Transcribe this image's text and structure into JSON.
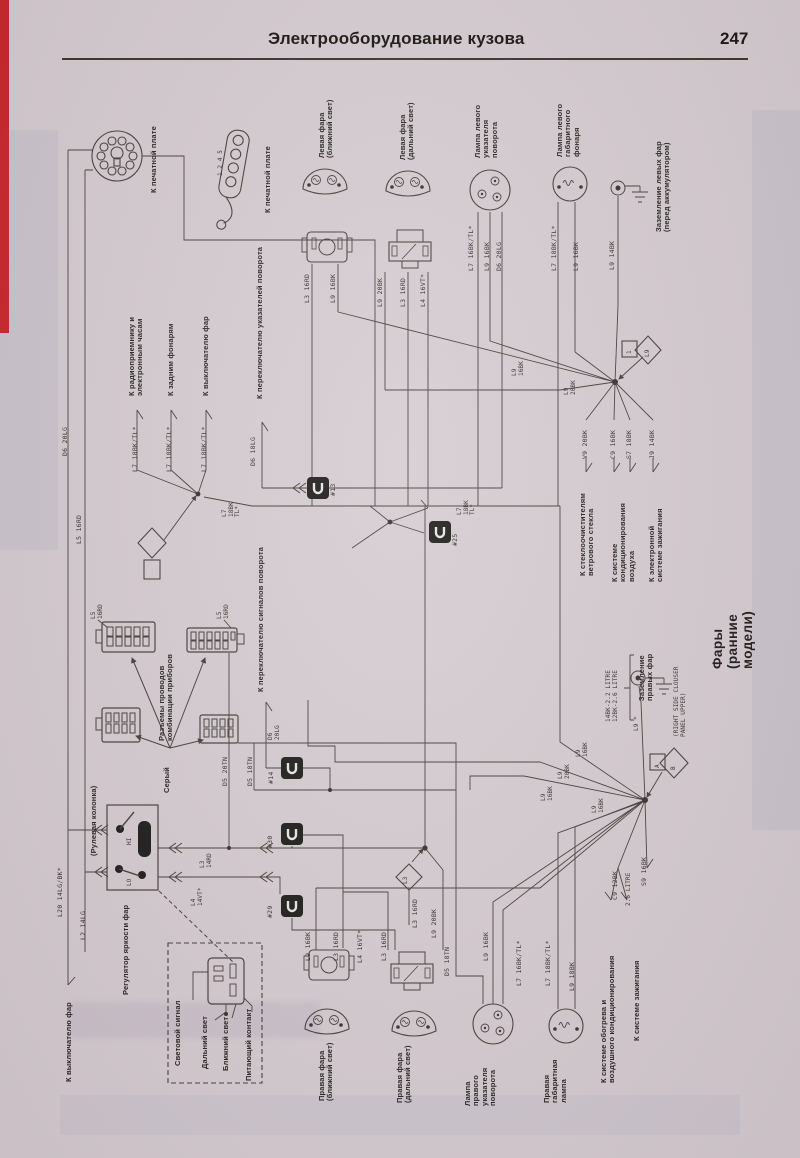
{
  "header": {
    "title": "Электрооборудование кузова",
    "page_number": "247"
  },
  "colors": {
    "paper": "#d5ccd1",
    "ink": "#45403a",
    "stripe_red": "#c9252b"
  },
  "diagram": {
    "title": "Фары (ранние модели)",
    "labels": [
      {
        "t": "К печатной плате",
        "x": 150,
        "y": 193,
        "c": "comp"
      },
      {
        "t": "К печатной плате",
        "x": 264,
        "y": 213,
        "c": "comp"
      },
      {
        "t": "1 2 4 5",
        "x": 218,
        "y": 176,
        "c": "tiny",
        "n": "pin-numbers-label"
      },
      {
        "t": "Левая фара\n(ближний свет)",
        "x": 318,
        "y": 158,
        "c": "comp"
      },
      {
        "t": "Левая фара\n(дальний свет)",
        "x": 399,
        "y": 160,
        "c": "comp"
      },
      {
        "t": "Лампа левого\nуказателя\nповорота",
        "x": 474,
        "y": 158,
        "c": "comp"
      },
      {
        "t": "Лампа левого\nгабаритного\nфонаря",
        "x": 556,
        "y": 157,
        "c": "comp"
      },
      {
        "t": "Заземление левых фар\n(перед аккумулятором)",
        "x": 655,
        "y": 232,
        "c": "comp"
      },
      {
        "t": "L3 16RD",
        "x": 304,
        "y": 303,
        "c": "wire"
      },
      {
        "t": "L9 16BK",
        "x": 330,
        "y": 303,
        "c": "wire"
      },
      {
        "t": "L9 20BK",
        "x": 377,
        "y": 307,
        "c": "wire"
      },
      {
        "t": "L3 16RD",
        "x": 400,
        "y": 307,
        "c": "wire"
      },
      {
        "t": "L4 16VT*",
        "x": 420,
        "y": 307,
        "c": "wire"
      },
      {
        "t": "L7 16BK/TL*",
        "x": 468,
        "y": 271,
        "c": "wire"
      },
      {
        "t": "L9 16BK",
        "x": 484,
        "y": 271,
        "c": "wire"
      },
      {
        "t": "D6 20LG",
        "x": 496,
        "y": 271,
        "c": "wire"
      },
      {
        "t": "L7 18BK/TL*",
        "x": 551,
        "y": 271,
        "c": "wire"
      },
      {
        "t": "L9 16BK",
        "x": 573,
        "y": 271,
        "c": "wire"
      },
      {
        "t": "L9 14BK",
        "x": 609,
        "y": 270,
        "c": "wire"
      },
      {
        "t": "К радиоприемнику и\nэлектронным часам",
        "x": 128,
        "y": 396,
        "c": "comp"
      },
      {
        "t": "К задним фонарям",
        "x": 167,
        "y": 396,
        "c": "comp"
      },
      {
        "t": "К выключателю фар",
        "x": 202,
        "y": 396,
        "c": "comp"
      },
      {
        "t": "К переключателю указателей поворота",
        "x": 256,
        "y": 399,
        "c": "comp"
      },
      {
        "t": "L7 18BK/TL*",
        "x": 132,
        "y": 472,
        "c": "wire"
      },
      {
        "t": "L7 18BK/TL*",
        "x": 166,
        "y": 472,
        "c": "wire"
      },
      {
        "t": "L7 18BK/TL*",
        "x": 201,
        "y": 472,
        "c": "wire"
      },
      {
        "t": "D6 18LG",
        "x": 250,
        "y": 466,
        "c": "wire"
      },
      {
        "t": "L7\n18BK\nTL*",
        "x": 222,
        "y": 517,
        "c": "tiny"
      },
      {
        "t": "#13",
        "x": 330,
        "y": 496,
        "c": "wire",
        "n": "connector-id-label"
      },
      {
        "t": "L7\n18BK\nTL*",
        "x": 457,
        "y": 515,
        "c": "tiny"
      },
      {
        "t": "#25",
        "x": 452,
        "y": 546,
        "c": "wire",
        "n": "connector-id-label"
      },
      {
        "t": "L9\n16BK",
        "x": 512,
        "y": 376,
        "c": "tiny"
      },
      {
        "t": "L9\n20BK",
        "x": 564,
        "y": 395,
        "c": "tiny"
      },
      {
        "t": "L9",
        "x": 645,
        "y": 357,
        "c": "tiny",
        "n": "splice-id-label"
      },
      {
        "t": "1",
        "x": 627,
        "y": 354,
        "c": "tiny",
        "n": "splice-id-label"
      },
      {
        "t": "V9 20BK",
        "x": 582,
        "y": 459,
        "c": "wire"
      },
      {
        "t": "C9 16BK",
        "x": 610,
        "y": 459,
        "c": "wire"
      },
      {
        "t": "S7 18BK",
        "x": 626,
        "y": 459,
        "c": "wire"
      },
      {
        "t": "J9 14BK",
        "x": 649,
        "y": 459,
        "c": "wire"
      },
      {
        "t": "К стеклоочистителям\nветрового стекла",
        "x": 579,
        "y": 576,
        "c": "comp"
      },
      {
        "t": "К системе\nкондиционирования\nвоздуха",
        "x": 611,
        "y": 582,
        "c": "comp"
      },
      {
        "t": "К электронной\nсистеме зажигания",
        "x": 648,
        "y": 582,
        "c": "comp"
      },
      {
        "t": "D6 20LG",
        "x": 62,
        "y": 456,
        "c": "wire"
      },
      {
        "t": "L5 16RD",
        "x": 76,
        "y": 544,
        "c": "wire"
      },
      {
        "t": "L5\n16RD",
        "x": 91,
        "y": 619,
        "c": "tiny"
      },
      {
        "t": "L5\n16RD",
        "x": 217,
        "y": 619,
        "c": "tiny"
      },
      {
        "t": "Разъемы проводов\nкомбинации приборов",
        "x": 158,
        "y": 741,
        "c": "comp"
      },
      {
        "t": "Серый",
        "x": 163,
        "y": 793,
        "c": "comp"
      },
      {
        "t": "К переключателю сигналов поворота",
        "x": 257,
        "y": 692,
        "c": "comp"
      },
      {
        "t": "D6\n20LG",
        "x": 268,
        "y": 740,
        "c": "tiny"
      },
      {
        "t": "D5 20TN",
        "x": 222,
        "y": 786,
        "c": "wire"
      },
      {
        "t": "D5 18TN",
        "x": 247,
        "y": 786,
        "c": "wire"
      },
      {
        "t": "#14",
        "x": 268,
        "y": 784,
        "c": "wire",
        "n": "connector-id-label"
      },
      {
        "t": "(Рулевая колонка)",
        "x": 90,
        "y": 856,
        "c": "comp"
      },
      {
        "t": "L20 14LG/BK*",
        "x": 57,
        "y": 917,
        "c": "wire"
      },
      {
        "t": "L2 14LG",
        "x": 80,
        "y": 940,
        "c": "wire"
      },
      {
        "t": "Регулятор яркости фар",
        "x": 122,
        "y": 995,
        "c": "comp"
      },
      {
        "t": "HI",
        "x": 127,
        "y": 845,
        "c": "tiny"
      },
      {
        "t": "LO",
        "x": 127,
        "y": 886,
        "c": "tiny"
      },
      {
        "t": "L3\n14RD",
        "x": 200,
        "y": 868,
        "c": "tiny"
      },
      {
        "t": "L4\n14VT*",
        "x": 191,
        "y": 906,
        "c": "tiny"
      },
      {
        "t": "#30",
        "x": 267,
        "y": 848,
        "c": "wire",
        "n": "connector-id-label"
      },
      {
        "t": "#29",
        "x": 267,
        "y": 918,
        "c": "wire",
        "n": "connector-id-label"
      },
      {
        "t": "Световой сигнал",
        "x": 174,
        "y": 1066,
        "c": "comp"
      },
      {
        "t": "Дальний свет",
        "x": 201,
        "y": 1069,
        "c": "comp"
      },
      {
        "t": "Ближний свет",
        "x": 222,
        "y": 1071,
        "c": "comp"
      },
      {
        "t": "Питающий контакт",
        "x": 245,
        "y": 1081,
        "c": "comp"
      },
      {
        "t": "К выключателю фар",
        "x": 65,
        "y": 1082,
        "c": "comp"
      },
      {
        "t": "L9 16BK",
        "x": 305,
        "y": 961,
        "c": "wire"
      },
      {
        "t": "L3 16RD",
        "x": 333,
        "y": 961,
        "c": "wire"
      },
      {
        "t": "L4 16VT*",
        "x": 357,
        "y": 963,
        "c": "wire"
      },
      {
        "t": "L3 16RD",
        "x": 381,
        "y": 961,
        "c": "wire"
      },
      {
        "t": "L3",
        "x": 403,
        "y": 884,
        "c": "tiny",
        "n": "splice-id-label"
      },
      {
        "t": "L3 16RD",
        "x": 412,
        "y": 928,
        "c": "wire"
      },
      {
        "t": "L9 20BK",
        "x": 431,
        "y": 938,
        "c": "wire"
      },
      {
        "t": "D5 18TN",
        "x": 444,
        "y": 976,
        "c": "wire"
      },
      {
        "t": "L9 16BK",
        "x": 483,
        "y": 961,
        "c": "wire"
      },
      {
        "t": "L7 16BK/TL*",
        "x": 516,
        "y": 986,
        "c": "wire"
      },
      {
        "t": "L7 18BK/TL*",
        "x": 545,
        "y": 986,
        "c": "wire"
      },
      {
        "t": "L9 18BK",
        "x": 569,
        "y": 991,
        "c": "wire"
      },
      {
        "t": "Правая фара\n(ближний свет)",
        "x": 318,
        "y": 1101,
        "c": "comp"
      },
      {
        "t": "Правая фара\n(дальний свет)",
        "x": 396,
        "y": 1103,
        "c": "comp"
      },
      {
        "t": "Лампа\nправого\nуказателя\nповорота",
        "x": 464,
        "y": 1106,
        "c": "comp"
      },
      {
        "t": "Правая\nгабаритная\nлампа",
        "x": 543,
        "y": 1103,
        "c": "comp"
      },
      {
        "t": "К системе обогрева и\nвоздушного кондиционирования",
        "x": 600,
        "y": 1083,
        "c": "comp"
      },
      {
        "t": "К системе зажигания",
        "x": 633,
        "y": 1041,
        "c": "comp"
      },
      {
        "t": "Заземление\nправых фар",
        "x": 638,
        "y": 701,
        "c": "comp"
      },
      {
        "t": "14BK-2.2 LITRE\n12BK-2.6 LITRE",
        "x": 606,
        "y": 722,
        "c": "tiny"
      },
      {
        "t": "(RIGHT SIDE CLOUSER\nPANEL UPPER)",
        "x": 674,
        "y": 737,
        "c": "tiny"
      },
      {
        "t": "L9 *",
        "x": 634,
        "y": 731,
        "c": "tiny"
      },
      {
        "t": "L9\n16BK",
        "x": 576,
        "y": 757,
        "c": "tiny"
      },
      {
        "t": "L9\n20BK",
        "x": 558,
        "y": 779,
        "c": "tiny"
      },
      {
        "t": "L9\n16BK",
        "x": 541,
        "y": 801,
        "c": "tiny"
      },
      {
        "t": "L9\n16BK",
        "x": 592,
        "y": 813,
        "c": "tiny"
      },
      {
        "t": "C9 12BK",
        "x": 612,
        "y": 900,
        "c": "wire"
      },
      {
        "t": "2.6 LITRE",
        "x": 626,
        "y": 906,
        "c": "tiny"
      },
      {
        "t": "S9 16BK",
        "x": 641,
        "y": 886,
        "c": "wire"
      },
      {
        "t": "A",
        "x": 655,
        "y": 768,
        "c": "tiny",
        "n": "splice-id-label"
      },
      {
        "t": "B",
        "x": 671,
        "y": 770,
        "c": "tiny",
        "n": "splice-id-label"
      },
      {
        "t": "Фары (ранние модели)",
        "x": 710,
        "y": 669,
        "c": "big",
        "n": "diagram-title"
      }
    ]
  }
}
